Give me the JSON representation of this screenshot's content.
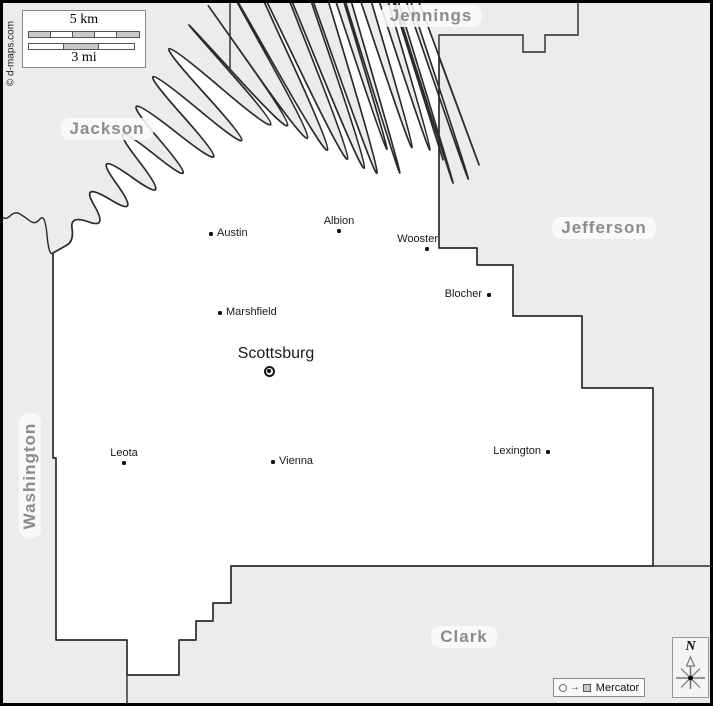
{
  "attribution": "© d-maps.com",
  "scale_bar": {
    "km_label": "5 km",
    "mi_label": "3 mi",
    "km_segments": 5,
    "mi_segments": 3
  },
  "neighbor_counties": [
    {
      "name": "Jennings"
    },
    {
      "name": "Jackson"
    },
    {
      "name": "Jefferson"
    },
    {
      "name": "Washington"
    },
    {
      "name": "Clark"
    }
  ],
  "county_seat": {
    "name": "Scottsburg"
  },
  "towns": [
    {
      "name": "Austin"
    },
    {
      "name": "Albion"
    },
    {
      "name": "Wooster"
    },
    {
      "name": "Blocher"
    },
    {
      "name": "Marshfield"
    },
    {
      "name": "Leota"
    },
    {
      "name": "Vienna"
    },
    {
      "name": "Lexington"
    }
  ],
  "legend": {
    "projection_label": "Mercator"
  },
  "compass": {
    "north_label": "N"
  },
  "colors": {
    "outside_fill": "#ececec",
    "county_fill": "#ffffff",
    "boundary_stroke": "#2b2b2b",
    "neighbor_label_text": "#8c8c8c",
    "frame": "#000000"
  }
}
